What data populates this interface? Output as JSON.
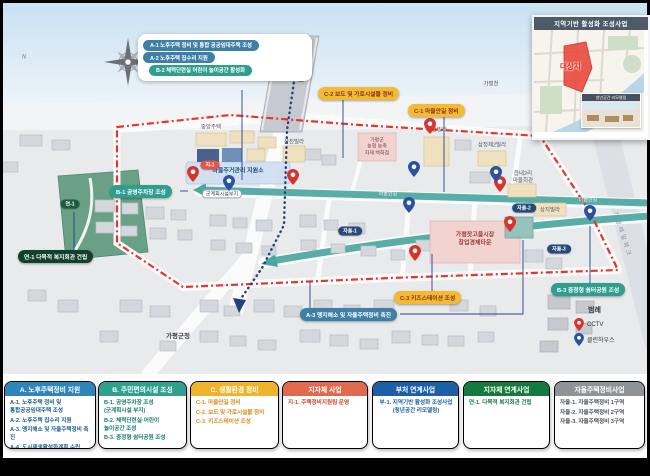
{
  "compass": {
    "north_label": "N"
  },
  "inset": {
    "title": "지역기반 활성화 조성사업",
    "target_label": "대상지",
    "photo_caption": "청년공간 리모델링"
  },
  "callout_box": {
    "items": [
      {
        "label": "A-1 노후주택 정비 및 통합 공공임대주택 조성",
        "bg": "#3f7fa6"
      },
      {
        "label": "A-2 노후주택 집수리 지원",
        "bg": "#3f7fa6"
      },
      {
        "label": "B-2 체력단련실 어린이 놀이공간 활성화",
        "bg": "#2f9e8f"
      }
    ]
  },
  "callouts": [
    {
      "id": "B-1",
      "label": "B-1 공영주차장 조성",
      "bg": "#2f9e8f",
      "fg": "#ffffff"
    },
    {
      "id": "C-2",
      "label": "C-2 보도 및 가로시설물 정비",
      "bg": "#f2bb33",
      "fg": "#8a2f23"
    },
    {
      "id": "C-1",
      "label": "C-1 마을안길 정비",
      "bg": "#f2bb33",
      "fg": "#8a2f23"
    },
    {
      "id": "연-1",
      "label": "연-1 다목적 복지회관 건립",
      "bg": "#12402e",
      "fg": "#ffffff"
    },
    {
      "id": "A-3",
      "label": "A-3 맹지해소 및 자율주택정비 촉진",
      "bg": "#3f7fa6",
      "fg": "#ffffff"
    },
    {
      "id": "C-3",
      "label": "C-3 키즈스테이션 조성",
      "bg": "#f2bb33",
      "fg": "#8a2f23"
    },
    {
      "id": "B-3",
      "label": "B-3 중정형 쉼터공원 조성",
      "bg": "#2f9e8f",
      "fg": "#ffffff"
    }
  ],
  "area_pills": [
    {
      "label": "지-1",
      "bg": "#e25549"
    },
    {
      "label": "연-1",
      "bg": "#1d5c3f"
    },
    {
      "label": "자율-1",
      "bg": "#274a77"
    },
    {
      "label": "자율-2",
      "bg": "#274a77"
    },
    {
      "label": "자율-3",
      "bg": "#274a77"
    }
  ],
  "map_labels": [
    {
      "text": "중앙주택"
    },
    {
      "text": "삼진빌라"
    },
    {
      "text": "가평군\n농협 농축\n자재 백화점"
    },
    {
      "text": "마을주거관리 지원소"
    },
    {
      "text": "군계획시설부지"
    },
    {
      "text": "대한빌라"
    },
    {
      "text": "삼정제2빌라"
    },
    {
      "text": "읍내2리\n마을회관"
    },
    {
      "text": "상지빌라"
    },
    {
      "text": "가평잣고을시장\n창업경제타운"
    },
    {
      "text": "가화교"
    },
    {
      "text": "가평천"
    },
    {
      "text": "가평군청"
    },
    {
      "text": "가평레일파크"
    },
    {
      "text": "마을안길"
    },
    {
      "text": "마을안길"
    }
  ],
  "map_legend": {
    "title": "범례",
    "items": [
      {
        "label": "CCTV",
        "color": "#d9342c"
      },
      {
        "label": "클린하우스",
        "color": "#2a52a0"
      }
    ]
  },
  "pins": {
    "red": [
      [
        193,
        181
      ],
      [
        293,
        184
      ],
      [
        430,
        133
      ],
      [
        500,
        191
      ],
      [
        510,
        231
      ],
      [
        415,
        260
      ]
    ],
    "blue": [
      [
        229,
        190
      ],
      [
        414,
        176
      ],
      [
        409,
        212
      ],
      [
        496,
        181
      ],
      [
        590,
        220
      ]
    ]
  },
  "colors": {
    "boundary": "#e8332a",
    "village_road": "#4aa7a0",
    "route_dotted": "#24417c",
    "park": "#6aa086"
  },
  "legend_cards": [
    {
      "title": "A. 노후주택정비 지원",
      "color": "#2e86b8",
      "text_color": "#1a5f8a",
      "items": [
        "A-1. 노후주택 정비 및\n통합공공임대주택 조성",
        "A-2. 노후주택 집수리 지원",
        "A-3. 맹지해소 및 자율주택정비 촉진",
        "A-4. 도시재생활성화계획 수립"
      ]
    },
    {
      "title": "B. 주민편의시설 조성",
      "color": "#2fa08e",
      "text_color": "#177d6d",
      "items": [
        "B-1. 공영주차장 조성\n(군계획시설 부지)",
        "B-2. 체력단련실·어린이\n놀이공간 조성",
        "B-3. 중정형 쉼터공원 조성"
      ]
    },
    {
      "title": "C. 생활환경 정비",
      "color": "#f0b42c",
      "text_color": "#db8a1d",
      "items": [
        "C-1. 마을안길 정비",
        "C-2. 보도 및 가로시설물 정비",
        "C-3. 키즈스테이션 조성"
      ]
    },
    {
      "title": "지자체 사업",
      "color": "#e06a4e",
      "text_color": "#cc4125",
      "items": [
        "지-1. 주택정비지원팀 운영"
      ]
    },
    {
      "title": "부처 연계사업",
      "color": "#1d5fa7",
      "text_color": "#1d5fa7",
      "items": [
        "부-1. 지역기반 활성화 조성사업\n(청년공간 리모델링)"
      ]
    },
    {
      "title": "지자체 연계사업",
      "color": "#16793f",
      "text_color": "#16793f",
      "items": [
        "연-1. 다목적 복지회관 건립"
      ]
    },
    {
      "title": "자율주택정비사업",
      "color": "#8f9397",
      "text_color": "#4d5156",
      "items": [
        "자율-1. 자율주택정비 1구역",
        "자율-2. 자율주택정비 2구역",
        "자율-3. 자율주택정비 3구역"
      ]
    }
  ]
}
